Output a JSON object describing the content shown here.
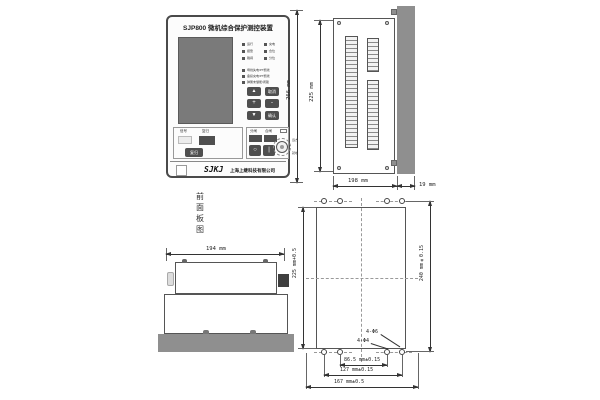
{
  "front_panel": {
    "title": "SJP800 微机综合保护测控装置",
    "caption": "前面板图",
    "led_rows": [
      [
        "运行",
        "充电"
      ],
      [
        "报警",
        "合位"
      ],
      [
        "跳闸",
        "分位"
      ]
    ],
    "led_long": [
      "母线失电/PT断线",
      "备投充电/PT断线",
      "弹簧未储能/闭锁"
    ],
    "keypad": [
      "▲",
      "取消",
      "+",
      "-",
      "▼",
      "确认"
    ],
    "signal_group": {
      "label_signal": "信号",
      "label_reset": "复归",
      "reset_button": "复归"
    },
    "switch_group": {
      "open_label": "分闸",
      "close_label": "合闸",
      "open_symbol": "○",
      "close_symbol": "|",
      "rotary_right": "远方",
      "rotary_left": "就地"
    },
    "brand": {
      "logo": "SJKJ",
      "company": "上海上继科技有限公司"
    }
  },
  "side_view": {
    "dim_total_height": "266 mm",
    "dim_case_height": "225 mm",
    "dim_depth": "198 mm",
    "dim_panel_thickness": "19 mm"
  },
  "top_view": {
    "dim_width": "194 mm"
  },
  "cutout_view": {
    "dim_cutout_height": "225 mm+0.5",
    "dim_hole_height": "240 mm±0.15",
    "dim_hole_w_inner": "86.5 mm±0.15",
    "dim_hole_w_outer": "127 mm±0.15",
    "dim_cutout_width": "167 mm±0.5",
    "callout_phi6": "4-Φ6",
    "callout_phi4": "4-Φ4"
  }
}
